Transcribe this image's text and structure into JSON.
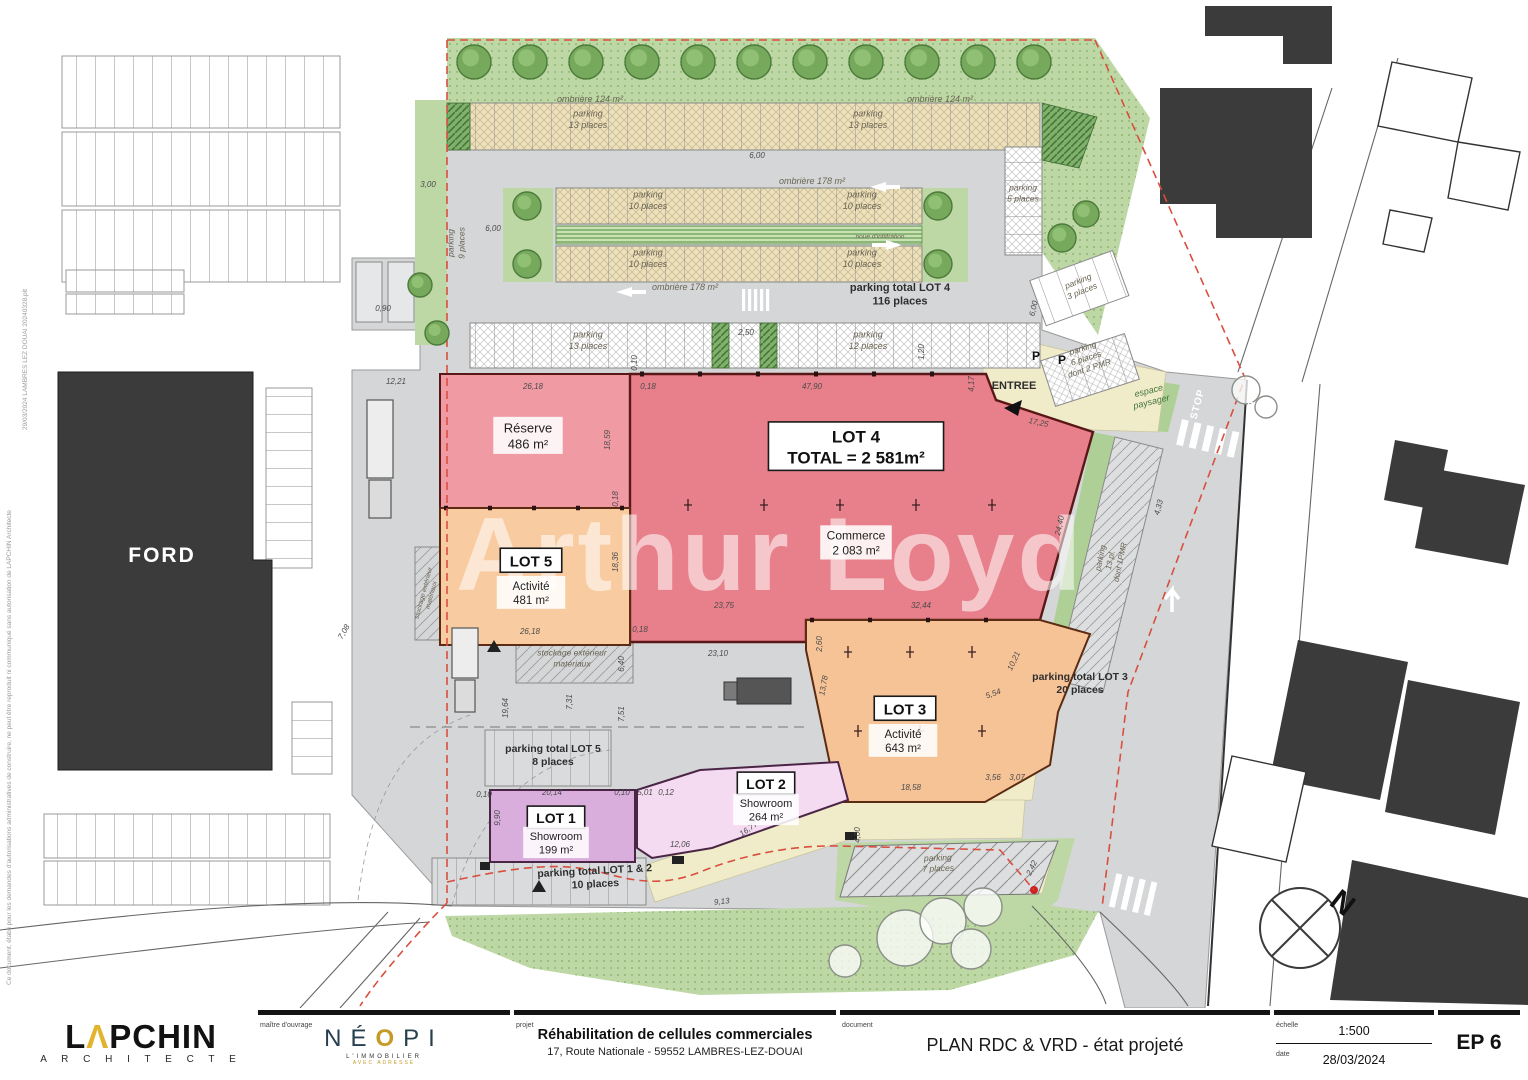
{
  "colors": {
    "boundary": "#d94f3f",
    "lot4_red": "#e8808b",
    "reserve_pink": "#f09aa4",
    "lot_orange": "#f6c397",
    "lot1_purple": "#d9aedd",
    "lot2_pink": "#f4dbf2",
    "walkway_beige": "#f0ebc8",
    "asphalt": "#d4d6d7",
    "green": "#bdd8a4",
    "building_black": "#3b3b3b",
    "logo_yellow": "#e3b32c",
    "neopi_gold": "#c59a27"
  },
  "title_block": {
    "architect": {
      "p1": "L",
      "a": "Λ",
      "p2": "PCHIN",
      "sub": "A R C H I T E C T E"
    },
    "client_label": "maître d'ouvrage",
    "client": {
      "n1": "NÉ",
      "o": "O",
      "n2": "PI",
      "sub1": "L'IMMOBILIER",
      "sub2": "AVEC ADRESSE"
    },
    "project_label": "projet",
    "project": {
      "line1": "Réhabilitation de cellules commerciales",
      "line2": "17, Route Nationale - 59552 LAMBRES-LEZ-DOUAI"
    },
    "document_label": "document",
    "document_title": "PLAN RDC & VRD - état projeté",
    "scale_label": "échelle",
    "scale_value": "1:500",
    "date_label": "date",
    "date_value": "28/03/2024",
    "sheet_number": "EP 6"
  },
  "plan": {
    "watermark": "Arthur Loyd",
    "ford": "FORD",
    "north": "N",
    "p_sign": "P",
    "notes": {
      "file": "29/03/2024 LAMBRES LEZ DOUAI 20240328.plt",
      "disclaimer": "Ce document, établi pour les demandes d'autorisations administratives de construire, ne peut être reproduit ni communiqué sans autorisation de LAPCHIN Architecte"
    },
    "labels": [
      {
        "n": "ombriere-left-label",
        "x": 590,
        "y": 99,
        "r": 0,
        "s": 9,
        "st": "i",
        "l": [
          "ombrière 124 m²"
        ]
      },
      {
        "n": "ombriere-right-label",
        "x": 940,
        "y": 99,
        "r": 0,
        "s": 9,
        "st": "i",
        "l": [
          "ombrière 124 m²"
        ]
      },
      {
        "n": "parking-13-top-left-label",
        "x": 588,
        "y": 119,
        "r": 0,
        "s": 9,
        "st": "i",
        "l": [
          "parking",
          "13 places"
        ]
      },
      {
        "n": "parking-13-top-right-label",
        "x": 868,
        "y": 119,
        "r": 0,
        "s": 9,
        "st": "i",
        "l": [
          "parking",
          "13 places"
        ]
      },
      {
        "n": "ombriere-178-upper-label",
        "x": 812,
        "y": 181,
        "r": 0,
        "s": 9,
        "st": "i",
        "l": [
          "ombrière 178 m²"
        ]
      },
      {
        "n": "parking-10-nw-label",
        "x": 648,
        "y": 200,
        "r": 0,
        "s": 9,
        "st": "i",
        "l": [
          "parking",
          "10 places"
        ]
      },
      {
        "n": "parking-10-ne-label",
        "x": 862,
        "y": 200,
        "r": 0,
        "s": 9,
        "st": "i",
        "l": [
          "parking",
          "10 places"
        ]
      },
      {
        "n": "parking-10-sw-label",
        "x": 648,
        "y": 258,
        "r": 0,
        "s": 9,
        "st": "i",
        "l": [
          "parking",
          "10 places"
        ]
      },
      {
        "n": "parking-10-se-label",
        "x": 862,
        "y": 258,
        "r": 0,
        "s": 9,
        "st": "i",
        "l": [
          "parking",
          "10 places"
        ]
      },
      {
        "n": "ombriere-178-lower-label",
        "x": 685,
        "y": 287,
        "r": 0,
        "s": 9,
        "st": "i",
        "l": [
          "ombrière 178 m²"
        ]
      },
      {
        "n": "noue-infiltration-label",
        "x": 880,
        "y": 236,
        "r": 0,
        "s": 6.5,
        "st": "i",
        "l": [
          "noue d'infiltration"
        ]
      },
      {
        "n": "parking-total-lot4-label",
        "x": 900,
        "y": 294,
        "r": 0,
        "s": 11,
        "st": "b",
        "l": [
          "parking total LOT 4",
          "116 places"
        ]
      },
      {
        "n": "parking-5-places-label",
        "x": 1023,
        "y": 193,
        "r": 0,
        "s": 8.5,
        "st": "i",
        "l": [
          "parking",
          "5 places"
        ]
      },
      {
        "n": "parking-9-places-label",
        "x": 456,
        "y": 243,
        "r": -90,
        "s": 8.5,
        "st": "i",
        "l": [
          "parking",
          "9 places"
        ]
      },
      {
        "n": "parking-13-row-label",
        "x": 588,
        "y": 340,
        "r": 0,
        "s": 9,
        "st": "i",
        "l": [
          "parking",
          "13 places"
        ]
      },
      {
        "n": "parking-12-places-label",
        "x": 868,
        "y": 340,
        "r": 0,
        "s": 9,
        "st": "i",
        "l": [
          "parking",
          "12 places"
        ]
      },
      {
        "n": "parking-3-places-label",
        "x": 1080,
        "y": 286,
        "r": -22,
        "s": 8.5,
        "st": "i",
        "l": [
          "parking",
          "3 places"
        ]
      },
      {
        "n": "parking-6-pmr-label",
        "x": 1086,
        "y": 358,
        "r": -18,
        "s": 8.5,
        "st": "i",
        "l": [
          "parking",
          "6 places",
          "dont 2 PMR"
        ]
      },
      {
        "n": "espace-paysager-label",
        "x": 1150,
        "y": 396,
        "r": -14,
        "s": 9,
        "st": "ig",
        "l": [
          "espace",
          "paysager"
        ]
      },
      {
        "n": "reserve-label",
        "x": 528,
        "y": 436,
        "r": 0,
        "s": 13,
        "st": "bg",
        "l": [
          "Réserve",
          "486 m²"
        ]
      },
      {
        "n": "lot4-title-label",
        "x": 856,
        "y": 447,
        "r": 0,
        "s": 17,
        "st": "box",
        "l": [
          "LOT 4",
          "TOTAL = 2 581m²"
        ]
      },
      {
        "n": "lot4-commerce-label",
        "x": 856,
        "y": 543,
        "r": 0,
        "s": 12,
        "st": "bg",
        "l": [
          "Commerce",
          "2 083 m²"
        ]
      },
      {
        "n": "lot5-title-label",
        "x": 531,
        "y": 561,
        "r": 0,
        "s": 15,
        "st": "box",
        "l": [
          "LOT 5"
        ]
      },
      {
        "n": "lot5-activite-label",
        "x": 531,
        "y": 593,
        "r": 0,
        "s": 11.5,
        "st": "bg",
        "l": [
          "Activité",
          "481 m²"
        ]
      },
      {
        "n": "lot3-title-label",
        "x": 905,
        "y": 709,
        "r": 0,
        "s": 15,
        "st": "box",
        "l": [
          "LOT 3"
        ]
      },
      {
        "n": "lot3-activite-label",
        "x": 903,
        "y": 741,
        "r": 0,
        "s": 11.5,
        "st": "bg",
        "l": [
          "Activité",
          "643 m²"
        ]
      },
      {
        "n": "lot2-title-label",
        "x": 766,
        "y": 784,
        "r": 0,
        "s": 14,
        "st": "box",
        "l": [
          "LOT 2"
        ]
      },
      {
        "n": "lot2-showroom-label",
        "x": 766,
        "y": 810,
        "r": 0,
        "s": 11,
        "st": "bg",
        "l": [
          "Showroom",
          "264 m²"
        ]
      },
      {
        "n": "lot1-title-label",
        "x": 556,
        "y": 818,
        "r": 0,
        "s": 14,
        "st": "box",
        "l": [
          "LOT 1"
        ]
      },
      {
        "n": "lot1-showroom-label",
        "x": 556,
        "y": 843,
        "r": 0,
        "s": 11,
        "st": "bg",
        "l": [
          "Showroom",
          "199 m²"
        ]
      },
      {
        "n": "parking-13pl-1pmr-label",
        "x": 1110,
        "y": 560,
        "r": -78,
        "s": 8,
        "st": "i",
        "l": [
          "parking",
          "13 pl.",
          "dont 1PMR"
        ]
      },
      {
        "n": "parking-total-lot3-label",
        "x": 1080,
        "y": 683,
        "r": 0,
        "s": 10.5,
        "st": "b",
        "l": [
          "parking total LOT 3",
          "20 places"
        ]
      },
      {
        "n": "stockage-exterieur-label",
        "x": 572,
        "y": 658,
        "r": 0,
        "s": 8.5,
        "st": "i",
        "l": [
          "stockage extérieur",
          "matériaux"
        ]
      },
      {
        "n": "stockage-exterieur-side-label",
        "x": 427,
        "y": 594,
        "r": -75,
        "s": 6.5,
        "st": "i",
        "l": [
          "stockage extérieur",
          "matériaux"
        ]
      },
      {
        "n": "parking-total-lot5-label",
        "x": 553,
        "y": 755,
        "r": 0,
        "s": 10.5,
        "st": "b",
        "l": [
          "parking total LOT 5",
          "8 places"
        ]
      },
      {
        "n": "parking-total-lot12-label",
        "x": 595,
        "y": 877,
        "r": -3,
        "s": 10.5,
        "st": "b",
        "l": [
          "parking total LOT 1 & 2",
          "10 places"
        ]
      },
      {
        "n": "parking-7-places-label",
        "x": 938,
        "y": 863,
        "r": -2,
        "s": 8.5,
        "st": "i",
        "l": [
          "parking",
          "7 places"
        ]
      },
      {
        "n": "entree-label",
        "x": 1014,
        "y": 385,
        "r": 0,
        "s": 11,
        "st": "b",
        "l": [
          "ENTREE"
        ]
      },
      {
        "n": "stop-marking-1",
        "x": 1197,
        "y": 404,
        "r": -75,
        "s": 10,
        "st": "bw",
        "l": [
          "STOP"
        ]
      },
      {
        "n": "stop-marking-2",
        "x": 1253,
        "y": 398,
        "r": -75,
        "s": 10,
        "st": "bw",
        "l": [
          "STOP"
        ]
      }
    ],
    "dimensions": [
      [
        "12,21",
        396,
        384,
        0
      ],
      [
        "26,18",
        533,
        389,
        0
      ],
      [
        "47,90",
        812,
        389,
        0
      ],
      [
        "0,18",
        648,
        389,
        0
      ],
      [
        "18,59",
        610,
        440,
        -90
      ],
      [
        "0,18",
        618,
        499,
        -90
      ],
      [
        "18,36",
        618,
        562,
        -90
      ],
      [
        "26,18",
        530,
        634,
        0
      ],
      [
        "0,18",
        640,
        632,
        0
      ],
      [
        "23,75",
        724,
        608,
        0
      ],
      [
        "32,44",
        921,
        608,
        0
      ],
      [
        "23,10",
        718,
        656,
        0
      ],
      [
        "2,60",
        822,
        644,
        -90
      ],
      [
        "6,40",
        624,
        664,
        -90
      ],
      [
        "7,51",
        624,
        714,
        -90
      ],
      [
        "19,64",
        508,
        708,
        -90
      ],
      [
        "7,31",
        572,
        702,
        -90
      ],
      [
        "10,21",
        1016,
        662,
        -65
      ],
      [
        "13,78",
        826,
        686,
        -80
      ],
      [
        "5,54",
        994,
        696,
        -20
      ],
      [
        "18,58",
        911,
        790,
        0
      ],
      [
        "3,56",
        993,
        780,
        0
      ],
      [
        "3,07",
        1017,
        780,
        0
      ],
      [
        "20,14",
        552,
        795,
        0
      ],
      [
        "0,10",
        622,
        795,
        0
      ],
      [
        "5,01",
        645,
        795,
        0
      ],
      [
        "0,12",
        666,
        795,
        0
      ],
      [
        "12,06",
        680,
        847,
        0
      ],
      [
        "16,77",
        750,
        831,
        -35
      ],
      [
        "9,90",
        500,
        818,
        -90
      ],
      [
        "0,10",
        484,
        797,
        0
      ],
      [
        "9,13",
        722,
        904,
        -6
      ],
      [
        "4,00",
        860,
        835,
        -90
      ],
      [
        "2,42",
        1034,
        869,
        -65
      ],
      [
        "17,25",
        1038,
        425,
        12
      ],
      [
        "2,50",
        746,
        335,
        0
      ],
      [
        "1,20",
        924,
        352,
        -90
      ],
      [
        "4,17",
        974,
        384,
        -90
      ],
      [
        "6,00",
        493,
        231,
        0
      ],
      [
        "6,00",
        757,
        158,
        0
      ],
      [
        "3,00",
        428,
        187,
        0
      ],
      [
        "0,90",
        383,
        311,
        0
      ],
      [
        "6,00",
        1036,
        309,
        -78
      ],
      [
        "7,08",
        346,
        633,
        -60
      ],
      [
        "4,33",
        1161,
        508,
        -75
      ],
      [
        "24,40",
        1062,
        526,
        -78
      ],
      [
        "0,10",
        637,
        363,
        -90
      ]
    ],
    "trees_green": [
      [
        474,
        62,
        17
      ],
      [
        530,
        62,
        17
      ],
      [
        586,
        62,
        17
      ],
      [
        642,
        62,
        17
      ],
      [
        698,
        62,
        17
      ],
      [
        754,
        62,
        17
      ],
      [
        810,
        62,
        17
      ],
      [
        866,
        62,
        17
      ],
      [
        922,
        62,
        17
      ],
      [
        978,
        62,
        17
      ],
      [
        1034,
        62,
        17
      ],
      [
        527,
        206,
        14
      ],
      [
        527,
        264,
        14
      ],
      [
        938,
        206,
        14
      ],
      [
        938,
        264,
        14
      ],
      [
        1062,
        238,
        14
      ],
      [
        1086,
        214,
        13
      ],
      [
        420,
        285,
        12
      ],
      [
        437,
        333,
        12
      ]
    ],
    "trees_outline": [
      [
        905,
        938,
        28
      ],
      [
        943,
        921,
        23
      ],
      [
        971,
        949,
        20
      ],
      [
        845,
        961,
        16
      ],
      [
        983,
        907,
        19
      ],
      [
        1246,
        390,
        14
      ],
      [
        1266,
        407,
        11
      ]
    ],
    "plus_marks": [
      [
        688,
        505
      ],
      [
        764,
        505
      ],
      [
        840,
        505
      ],
      [
        916,
        505
      ],
      [
        992,
        505
      ],
      [
        848,
        652
      ],
      [
        910,
        652
      ],
      [
        972,
        652
      ],
      [
        858,
        731
      ],
      [
        920,
        731
      ],
      [
        982,
        731
      ]
    ]
  }
}
